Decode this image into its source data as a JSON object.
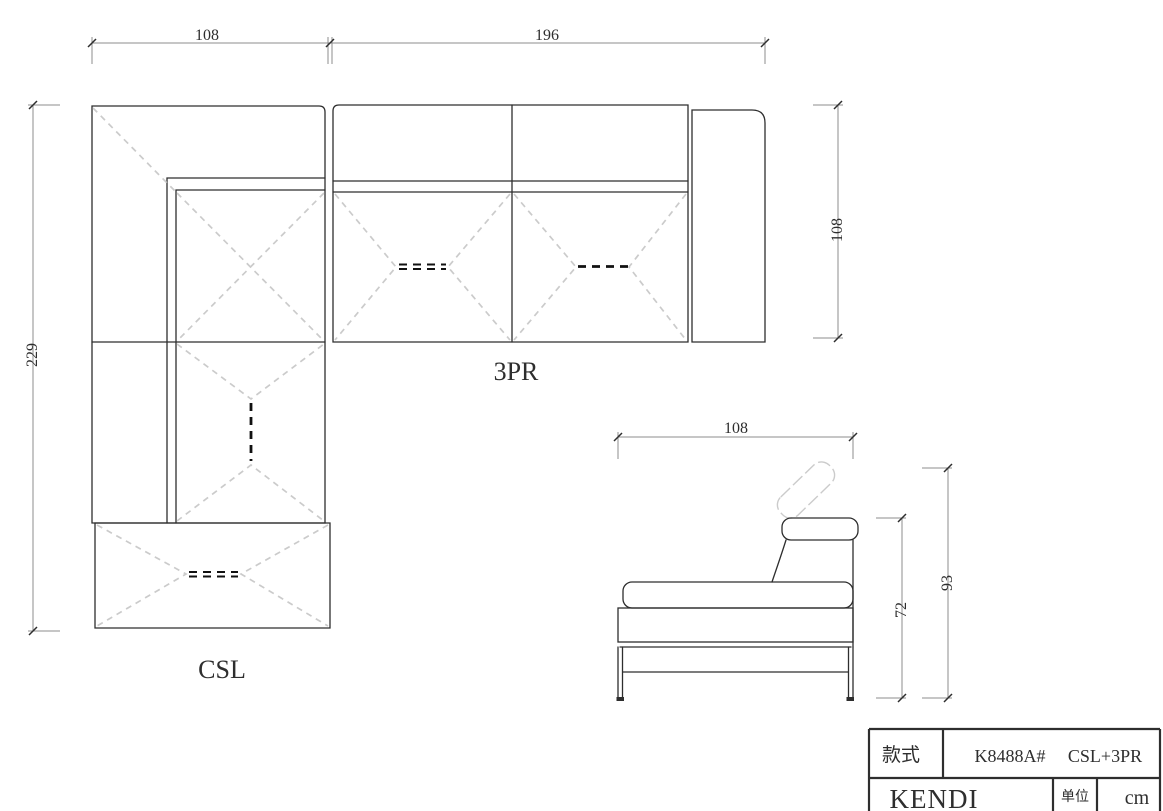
{
  "drawing": {
    "plan_labels": {
      "corner_unit": "CSL",
      "three_seater": "3PR"
    },
    "dimensions": {
      "csl_width": "108",
      "tpr_width": "196",
      "csl_total_depth": "229",
      "tpr_depth": "108",
      "side_width": "108",
      "seat_back_height": "72",
      "total_height": "93"
    }
  },
  "title_block": {
    "style_label": "款式",
    "model_code": "K8488A#",
    "configuration": "CSL+3PR",
    "brand": "KENDI",
    "unit_label": "单位",
    "unit_value": "cm"
  },
  "colors": {
    "line": "#2e2e2e",
    "dim": "#8c8c8c",
    "ghost": "#cbcbcb",
    "marker": "#111111",
    "background": "#ffffff"
  }
}
